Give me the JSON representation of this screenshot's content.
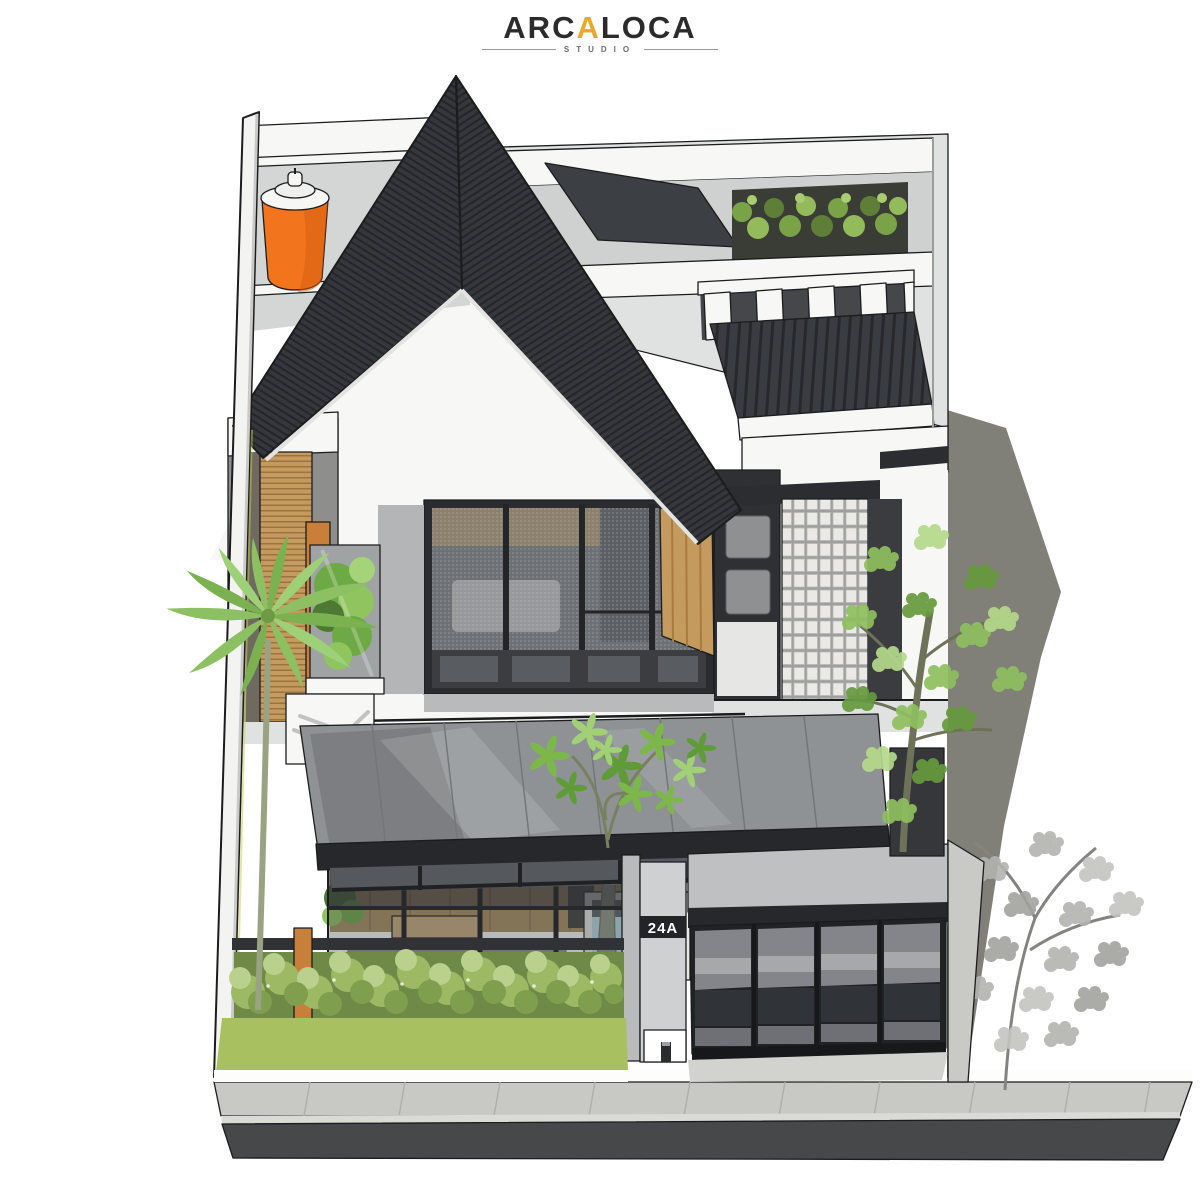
{
  "logo": {
    "part1": "ARC",
    "accent": "A",
    "part2": "LOCA",
    "subtitle": "STUDIO"
  },
  "house": {
    "number": "24A"
  },
  "palette": {
    "logoDark": "#2b2b2c",
    "logoGold": "#e5a92e",
    "outline": "#1b1c1e",
    "wallWhite": "#f7f7f5",
    "wallLight": "#e0e1e1",
    "wallMid": "#c2c3c4",
    "wallDark": "#8e8f8c",
    "roof": "#34373b",
    "roofStripe": "#24262a",
    "glass": "#6d7074",
    "glassDark": "#3c3f43",
    "wood": "#c59a5f",
    "woodDark": "#9a7440",
    "woodOrange": "#c87f3a",
    "tank": "#f2751d",
    "leaf": "#8fbf5f",
    "leafDark": "#679a3e",
    "leafLight": "#b4d98a",
    "palm": "#8cc063",
    "hedge": "#7aa348",
    "grass": "#a9c060",
    "bush": "#9db964",
    "pool": "#b8dde2",
    "road": "#46484a",
    "paver": "#c8c8c4",
    "shadowGray": "#807f78",
    "grayTree": "#b3b4af",
    "signBg": "#232427"
  }
}
